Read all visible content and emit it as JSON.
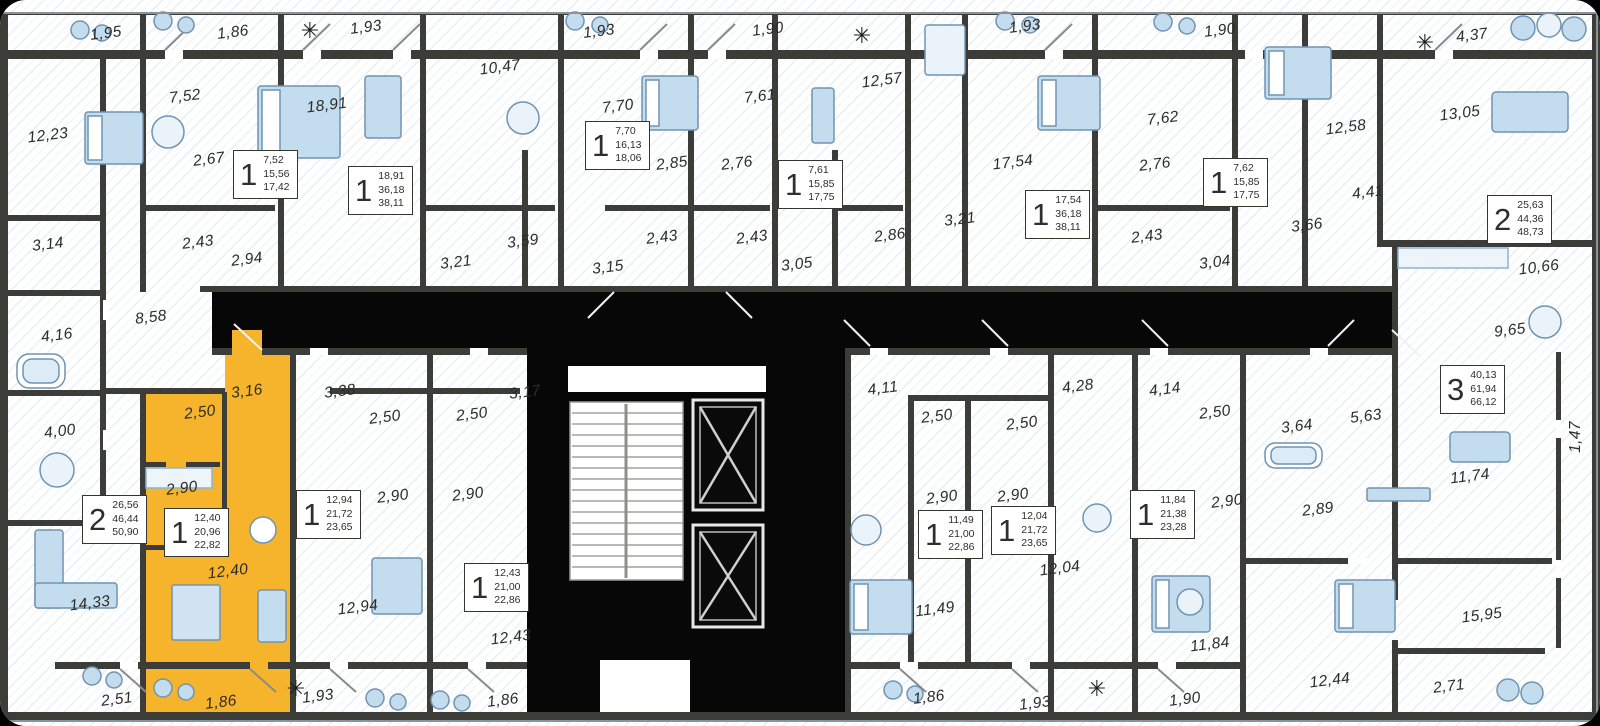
{
  "colors": {
    "wall": "#3c3c39",
    "corridor": "#070707",
    "highlight": "#f6b42c",
    "floor": "#ffffff",
    "hatch": "#dce5ec",
    "furniture_fill": "#c3dcee",
    "furniture_stroke": "#6f94b2",
    "label": "#2c2c2a"
  },
  "room_labels": [
    {
      "t": "1,95",
      "x": 106,
      "y": 34
    },
    {
      "t": "1,86",
      "x": 233,
      "y": 33
    },
    {
      "t": "1,93",
      "x": 366,
      "y": 28
    },
    {
      "t": "1,93",
      "x": 599,
      "y": 32
    },
    {
      "t": "1,90",
      "x": 768,
      "y": 30
    },
    {
      "t": "1,93",
      "x": 1025,
      "y": 27
    },
    {
      "t": "1,90",
      "x": 1220,
      "y": 31
    },
    {
      "t": "4,37",
      "x": 1472,
      "y": 36
    },
    {
      "t": "12,23",
      "x": 48,
      "y": 136
    },
    {
      "t": "7,52",
      "x": 185,
      "y": 97
    },
    {
      "t": "2,67",
      "x": 209,
      "y": 160
    },
    {
      "t": "18,91",
      "x": 327,
      "y": 106
    },
    {
      "t": "10,47",
      "x": 500,
      "y": 68
    },
    {
      "t": "7,70",
      "x": 618,
      "y": 107
    },
    {
      "t": "2,85",
      "x": 672,
      "y": 164
    },
    {
      "t": "2,76",
      "x": 737,
      "y": 164
    },
    {
      "t": "7,61",
      "x": 760,
      "y": 97
    },
    {
      "t": "12,57",
      "x": 882,
      "y": 81
    },
    {
      "t": "17,54",
      "x": 1013,
      "y": 163
    },
    {
      "t": "7,62",
      "x": 1163,
      "y": 119
    },
    {
      "t": "2,76",
      "x": 1155,
      "y": 165
    },
    {
      "t": "12,58",
      "x": 1346,
      "y": 128
    },
    {
      "t": "13,05",
      "x": 1460,
      "y": 114
    },
    {
      "t": "3,66",
      "x": 1307,
      "y": 226
    },
    {
      "t": "4,41",
      "x": 1368,
      "y": 193
    },
    {
      "t": "10,66",
      "x": 1539,
      "y": 268
    },
    {
      "t": "9,65",
      "x": 1510,
      "y": 331
    },
    {
      "t": "3,14",
      "x": 48,
      "y": 245
    },
    {
      "t": "2,43",
      "x": 198,
      "y": 243
    },
    {
      "t": "2,94",
      "x": 247,
      "y": 260
    },
    {
      "t": "8,58",
      "x": 151,
      "y": 318
    },
    {
      "t": "4,16",
      "x": 57,
      "y": 336
    },
    {
      "t": "4,00",
      "x": 60,
      "y": 432
    },
    {
      "t": "3,59",
      "x": 523,
      "y": 242
    },
    {
      "t": "3,21",
      "x": 456,
      "y": 263
    },
    {
      "t": "3,15",
      "x": 608,
      "y": 268
    },
    {
      "t": "2,43",
      "x": 662,
      "y": 238
    },
    {
      "t": "2,43",
      "x": 752,
      "y": 238
    },
    {
      "t": "3,05",
      "x": 797,
      "y": 265
    },
    {
      "t": "2,86",
      "x": 890,
      "y": 236
    },
    {
      "t": "3,21",
      "x": 960,
      "y": 220
    },
    {
      "t": "2,43",
      "x": 1147,
      "y": 237
    },
    {
      "t": "3,04",
      "x": 1215,
      "y": 263
    },
    {
      "t": "14,33",
      "x": 90,
      "y": 604
    },
    {
      "t": "2,51",
      "x": 117,
      "y": 700
    },
    {
      "t": "3,16",
      "x": 247,
      "y": 392
    },
    {
      "t": "2,50",
      "x": 200,
      "y": 413
    },
    {
      "t": "2,90",
      "x": 182,
      "y": 489
    },
    {
      "t": "12,40",
      "x": 228,
      "y": 572
    },
    {
      "t": "1,86",
      "x": 221,
      "y": 703
    },
    {
      "t": "3,38",
      "x": 340,
      "y": 392
    },
    {
      "t": "2,50",
      "x": 385,
      "y": 418
    },
    {
      "t": "2,50",
      "x": 472,
      "y": 415
    },
    {
      "t": "2,90",
      "x": 393,
      "y": 497
    },
    {
      "t": "2,90",
      "x": 468,
      "y": 495
    },
    {
      "t": "3,17",
      "x": 525,
      "y": 393
    },
    {
      "t": "12,94",
      "x": 358,
      "y": 608
    },
    {
      "t": "1,93",
      "x": 318,
      "y": 697
    },
    {
      "t": "12,43",
      "x": 511,
      "y": 638
    },
    {
      "t": "1,86",
      "x": 503,
      "y": 701
    },
    {
      "t": "4,11",
      "x": 883,
      "y": 389
    },
    {
      "t": "2,50",
      "x": 937,
      "y": 417
    },
    {
      "t": "2,50",
      "x": 1022,
      "y": 424
    },
    {
      "t": "4,28",
      "x": 1078,
      "y": 387
    },
    {
      "t": "4,14",
      "x": 1165,
      "y": 390
    },
    {
      "t": "2,90",
      "x": 942,
      "y": 498
    },
    {
      "t": "2,90",
      "x": 1013,
      "y": 496
    },
    {
      "t": "12,04",
      "x": 1060,
      "y": 569
    },
    {
      "t": "11,49",
      "x": 935,
      "y": 610
    },
    {
      "t": "1,86",
      "x": 929,
      "y": 698
    },
    {
      "t": "1,93",
      "x": 1035,
      "y": 704
    },
    {
      "t": "1,90",
      "x": 1185,
      "y": 700
    },
    {
      "t": "2,90",
      "x": 1227,
      "y": 502
    },
    {
      "t": "2,89",
      "x": 1318,
      "y": 510
    },
    {
      "t": "11,84",
      "x": 1210,
      "y": 645
    },
    {
      "t": "12,44",
      "x": 1330,
      "y": 681
    },
    {
      "t": "15,95",
      "x": 1482,
      "y": 616
    },
    {
      "t": "2,71",
      "x": 1449,
      "y": 687
    },
    {
      "t": "11,74",
      "x": 1470,
      "y": 477
    },
    {
      "t": "5,63",
      "x": 1366,
      "y": 417
    },
    {
      "t": "3,64",
      "x": 1297,
      "y": 427
    },
    {
      "t": "2,50",
      "x": 1215,
      "y": 413
    },
    {
      "t": "1,47",
      "x": 1576,
      "y": 437,
      "r": -90
    }
  ],
  "unit_cards": [
    {
      "rooms": "1",
      "areas": [
        "7,52",
        "15,56",
        "17,42"
      ],
      "x": 233,
      "y": 150
    },
    {
      "rooms": "1",
      "areas": [
        "18,91",
        "36,18",
        "38,11"
      ],
      "x": 348,
      "y": 166
    },
    {
      "rooms": "1",
      "areas": [
        "7,70",
        "16,13",
        "18,06"
      ],
      "x": 585,
      "y": 121
    },
    {
      "rooms": "1",
      "areas": [
        "7,61",
        "15,85",
        "17,75"
      ],
      "x": 778,
      "y": 160
    },
    {
      "rooms": "1",
      "areas": [
        "17,54",
        "36,18",
        "38,11"
      ],
      "x": 1025,
      "y": 190
    },
    {
      "rooms": "1",
      "areas": [
        "7,62",
        "15,85",
        "17,75"
      ],
      "x": 1203,
      "y": 158
    },
    {
      "rooms": "2",
      "areas": [
        "25,63",
        "44,36",
        "48,73"
      ],
      "x": 1487,
      "y": 195
    },
    {
      "rooms": "3",
      "areas": [
        "40,13",
        "61,94",
        "66,12"
      ],
      "x": 1440,
      "y": 365
    },
    {
      "rooms": "2",
      "areas": [
        "26,56",
        "46,44",
        "50,90"
      ],
      "x": 82,
      "y": 495
    },
    {
      "rooms": "1",
      "areas": [
        "12,40",
        "20,96",
        "22,82"
      ],
      "x": 164,
      "y": 508,
      "highlight": true
    },
    {
      "rooms": "1",
      "areas": [
        "12,94",
        "21,72",
        "23,65"
      ],
      "x": 296,
      "y": 490
    },
    {
      "rooms": "1",
      "areas": [
        "12,43",
        "21,00",
        "22,86"
      ],
      "x": 464,
      "y": 563
    },
    {
      "rooms": "1",
      "areas": [
        "11,49",
        "21,00",
        "22,86"
      ],
      "x": 918,
      "y": 510
    },
    {
      "rooms": "1",
      "areas": [
        "12,04",
        "21,72",
        "23,65"
      ],
      "x": 991,
      "y": 506
    },
    {
      "rooms": "1",
      "areas": [
        "11,84",
        "21,38",
        "23,28"
      ],
      "x": 1130,
      "y": 490
    }
  ]
}
